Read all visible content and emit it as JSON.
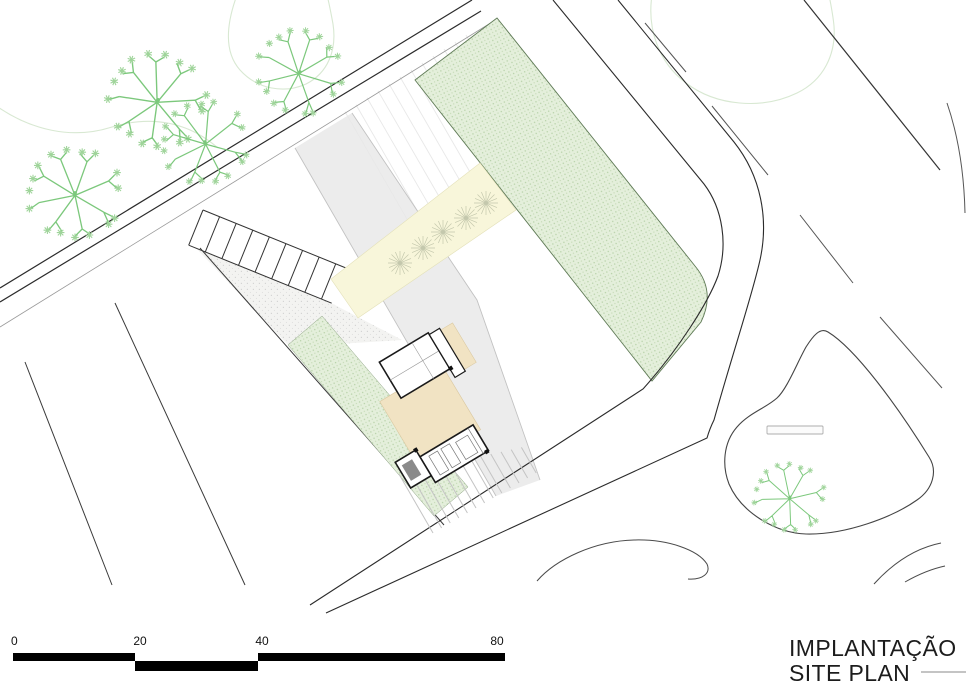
{
  "drawing_title": {
    "line1": "IMPLANTAÇÃO",
    "line2": "SITE PLAN"
  },
  "scale_bar": {
    "labels": [
      "0",
      "20",
      "40",
      "80"
    ]
  },
  "palette": {
    "vegetation_fill": "#e4efdb",
    "vegetation_dot": "#b4cfa5",
    "paved_court_fill": "#f3f3f1",
    "driveway_fill": "#ececec",
    "walkway_fill": "#f8f6da",
    "terrace_fill": "#f1e3c3",
    "road_line": "#2b2b2b",
    "tree_green": "#7cc87c",
    "foliage_green": "#9fd49a",
    "contour_green": "#d8e8d2",
    "scale_bar_fill": "#000000",
    "title_color": "#1c1c1c"
  },
  "icons": {
    "sketch_tree": "sketch-tree-icon",
    "walkway_tree": "star-tree-icon",
    "bench": "bench-icon"
  }
}
